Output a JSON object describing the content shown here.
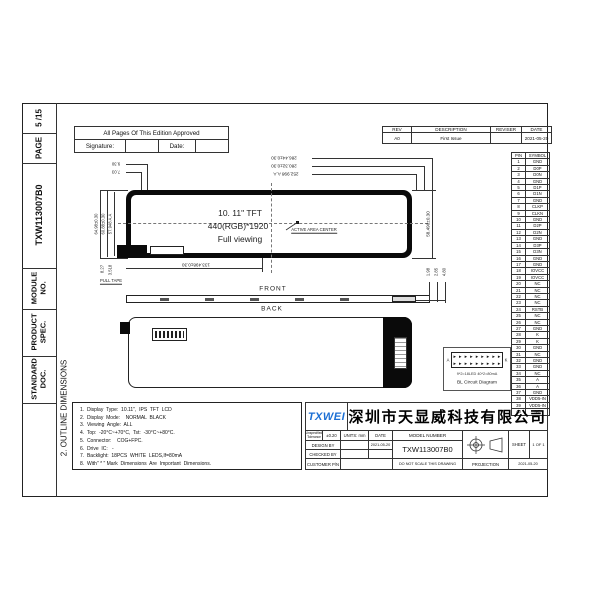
{
  "sidebar": {
    "cells": [
      {
        "label": "5 /15"
      },
      {
        "label": "PAGE"
      },
      {
        "label": "TXW113007B0"
      },
      {
        "label": "MODULE\nNO."
      },
      {
        "label": "PRODUCT\nSPEC."
      },
      {
        "label": "STANDARD\nDOC."
      }
    ],
    "section_title": "2. OUTLINE DIMENSIONS"
  },
  "approval": {
    "title": "All  Pages  Of  This  Edition  Approved",
    "signature_label": "Signature:",
    "date_label": "Date:"
  },
  "revision_table": {
    "headers": [
      "REV",
      "DESCRIPTION",
      "REVISER",
      "DATE"
    ],
    "rows": [
      [
        "A0",
        "First Issue",
        "",
        "2021-05-20"
      ]
    ]
  },
  "pin_table": {
    "headers": [
      "PIN",
      "SYMBOL"
    ],
    "rows": [
      [
        "1",
        "GND"
      ],
      [
        "2",
        "D0P"
      ],
      [
        "3",
        "D0N"
      ],
      [
        "4",
        "GND"
      ],
      [
        "5",
        "D1P"
      ],
      [
        "6",
        "D1N"
      ],
      [
        "7",
        "GND"
      ],
      [
        "8",
        "CLKP"
      ],
      [
        "9",
        "CLKN"
      ],
      [
        "10",
        "GND"
      ],
      [
        "11",
        "D2P"
      ],
      [
        "12",
        "D2N"
      ],
      [
        "13",
        "GND"
      ],
      [
        "14",
        "D3P"
      ],
      [
        "15",
        "D3N"
      ],
      [
        "16",
        "GND"
      ],
      [
        "17",
        "GND"
      ],
      [
        "18",
        "IOVCC"
      ],
      [
        "19",
        "IOVCC"
      ],
      [
        "20",
        "NC"
      ],
      [
        "21",
        "NC"
      ],
      [
        "22",
        "NC"
      ],
      [
        "23",
        "NC"
      ],
      [
        "24",
        "RSTB"
      ],
      [
        "25",
        "NC"
      ],
      [
        "26",
        "NC"
      ],
      [
        "27",
        "GND"
      ],
      [
        "28",
        "K"
      ],
      [
        "29",
        "K"
      ],
      [
        "30",
        "GND"
      ],
      [
        "31",
        "NC"
      ],
      [
        "32",
        "GND"
      ],
      [
        "33",
        "GND"
      ],
      [
        "34",
        "NC"
      ],
      [
        "35",
        "A"
      ],
      [
        "36",
        "A"
      ],
      [
        "37",
        "GND"
      ],
      [
        "38",
        "VDD5-IN"
      ],
      [
        "39",
        "VDD5-IN"
      ],
      [
        "40",
        "NC"
      ]
    ]
  },
  "drawing": {
    "panel_text": {
      "line1": "10. 11\" TFT",
      "line2": "440(RGB)*1920",
      "line3": "Full viewing"
    },
    "active_area_label": "ACTIVE  AREA  CENTER",
    "front_label": "FRONT",
    "back_label": "BACK",
    "pull_tape_label": "PULL  TAPE",
    "dims": {
      "top1": "286.44±0.30",
      "top2": "280.32±0.30",
      "top3": "252.998 A.A",
      "left1": "64.98±0.30",
      "left2": "60.88±0.30",
      "left3": "57.948 A.A",
      "right1": "58.490±0.30",
      "bottom1": "133.498±0.30",
      "top_left1": "9.30",
      "top_left2": "7.03",
      "bottom_left1": "8.27",
      "bottom_left2": "3.518",
      "thickness1": "1.98",
      "thickness2": "2.85",
      "thickness3": "4.80"
    },
    "bl_box": {
      "leds_per_row": 9,
      "anode": "A",
      "cathode": "K",
      "line1": "9*2=18LED  40*2=80mA",
      "line2": "BL Circuit Diagram"
    }
  },
  "notes": {
    "lines": [
      "1.  Display  Type:  10.11\",  IPS  TFT  LCD",
      "2.  Display  Mode:    NORMAL  BLACK",
      "3.  Viewing  Angle:  ALL",
      "4.  Top:  -20°C~+70°C,  Tst:  -30°C~+80°C.",
      "5.  Connector:    COG+FPC.",
      "6.  Drive  IC:   -",
      "7.  Backlight:  18PCS  WHITE  LEDS,If=80mA",
      "8.  With\" * \" Mark  Dimensions  Are  Important  Dimensions."
    ]
  },
  "title_block": {
    "logo": "TXWEI",
    "logo_color": "#1c6fd4",
    "company": "深圳市天显威科技有限公司",
    "tolerance_label": "Unspecified\nTolerance",
    "tolerance_value": "±0.20",
    "units": "UNITS: mm",
    "date_label": "DATE",
    "date_value": "2021-05-20",
    "model_number_label": "MODEL  NUMBER",
    "model_number": "TXW113007B0",
    "design_by": "DESIGN   BY",
    "checked_by": "CHECKED   BY",
    "customer_pn": "CUSTOMER P/N",
    "do_not_scale": "DO NOT SCALE THIS DRAWING",
    "projection_label": "PROJECTION",
    "sheet_label": "SHEET",
    "sheet_value": "1  OF  1",
    "footer_date": "2021-05-20"
  }
}
